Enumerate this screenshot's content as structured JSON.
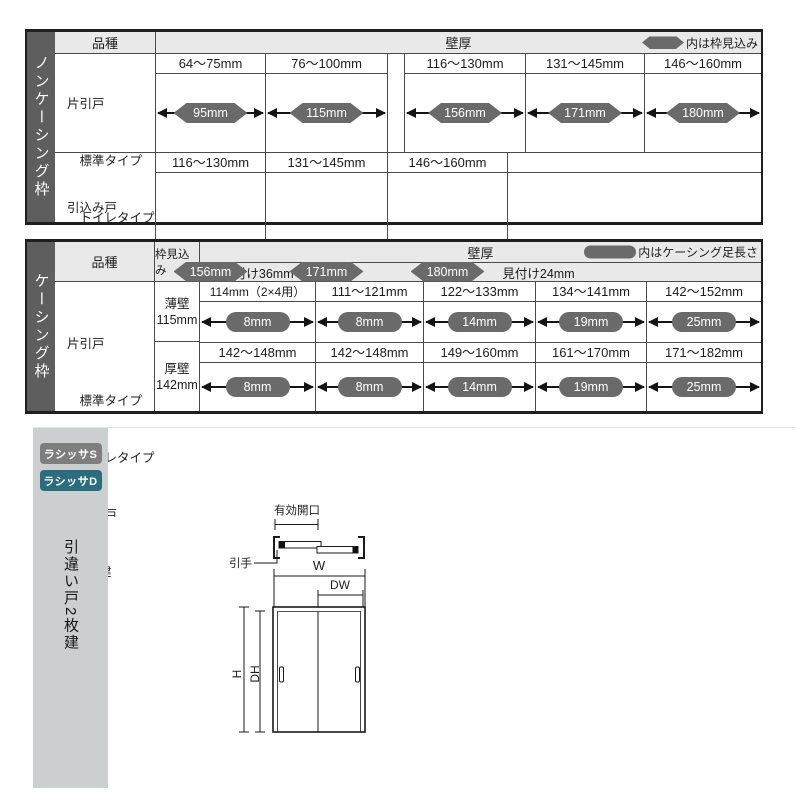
{
  "colors": {
    "pill": "#6a6a6a",
    "side_strip": "#5e5e5e",
    "header_bg": "#e9e9e9",
    "sidebar_bg": "#cbcfd0",
    "badge_s": "#7e7e7e",
    "badge_d": "#2b6d7c"
  },
  "table1": {
    "side_label": "ノンケーシング枠",
    "header": {
      "kind": "品種",
      "wall": "壁厚",
      "legend": "内は枠見込み"
    },
    "row1": {
      "label_lines": [
        "片引戸",
        "　標準タイプ",
        "　トイレタイプ",
        "引違い戸",
        "　2枚建"
      ],
      "cells": [
        {
          "range": "64〜75mm",
          "pill": "95mm"
        },
        {
          "range": "76〜100mm",
          "pill": "115mm"
        },
        {
          "range": "116〜130mm",
          "pill": "156mm"
        },
        {
          "range": "131〜145mm",
          "pill": "171mm"
        },
        {
          "range": "146〜160mm",
          "pill": "180mm"
        }
      ]
    },
    "row2": {
      "label_lines": [
        "引込み戸",
        "　標準タイプ",
        "　トイレタイプ"
      ],
      "cells": [
        {
          "range": "116〜130mm",
          "pill": "156mm"
        },
        {
          "range": "131〜145mm",
          "pill": "171mm"
        },
        {
          "range": "146〜160mm",
          "pill": "180mm"
        }
      ]
    }
  },
  "table2": {
    "side_label": "ケーシング枠",
    "header": {
      "kind": "品種",
      "depth": "枠見込み",
      "wall": "壁厚",
      "legend": "内はケーシング足長さ",
      "sub_left": "見付け36mm",
      "sub_right": "見付け24mm"
    },
    "label_lines": [
      "片引戸",
      "　標準タイプ",
      "　トイレタイプ",
      "引違い戸",
      "　2枚建"
    ],
    "row1": {
      "depth_lines": [
        "薄壁",
        "115mm"
      ],
      "cells": [
        {
          "range": "114mm（2×4用）",
          "pill": "8mm"
        },
        {
          "range": "111〜121mm",
          "pill": "8mm"
        },
        {
          "range": "122〜133mm",
          "pill": "14mm"
        },
        {
          "range": "134〜141mm",
          "pill": "19mm"
        },
        {
          "range": "142〜152mm",
          "pill": "25mm"
        }
      ]
    },
    "row2": {
      "depth_lines": [
        "厚壁",
        "142mm"
      ],
      "cells": [
        {
          "range": "142〜148mm",
          "pill": "8mm"
        },
        {
          "range": "142〜148mm",
          "pill": "8mm"
        },
        {
          "range": "149〜160mm",
          "pill": "14mm"
        },
        {
          "range": "161〜170mm",
          "pill": "19mm"
        },
        {
          "range": "171〜182mm",
          "pill": "25mm"
        }
      ]
    }
  },
  "bottom": {
    "badge_s": "ラシッサS",
    "badge_d": "ラシッサD",
    "side_label": "引違い戸2枚建",
    "diagram": {
      "opening": "有効開口",
      "handle": "引手",
      "w": "W",
      "dw": "DW",
      "h": "H",
      "dh": "DH"
    }
  }
}
